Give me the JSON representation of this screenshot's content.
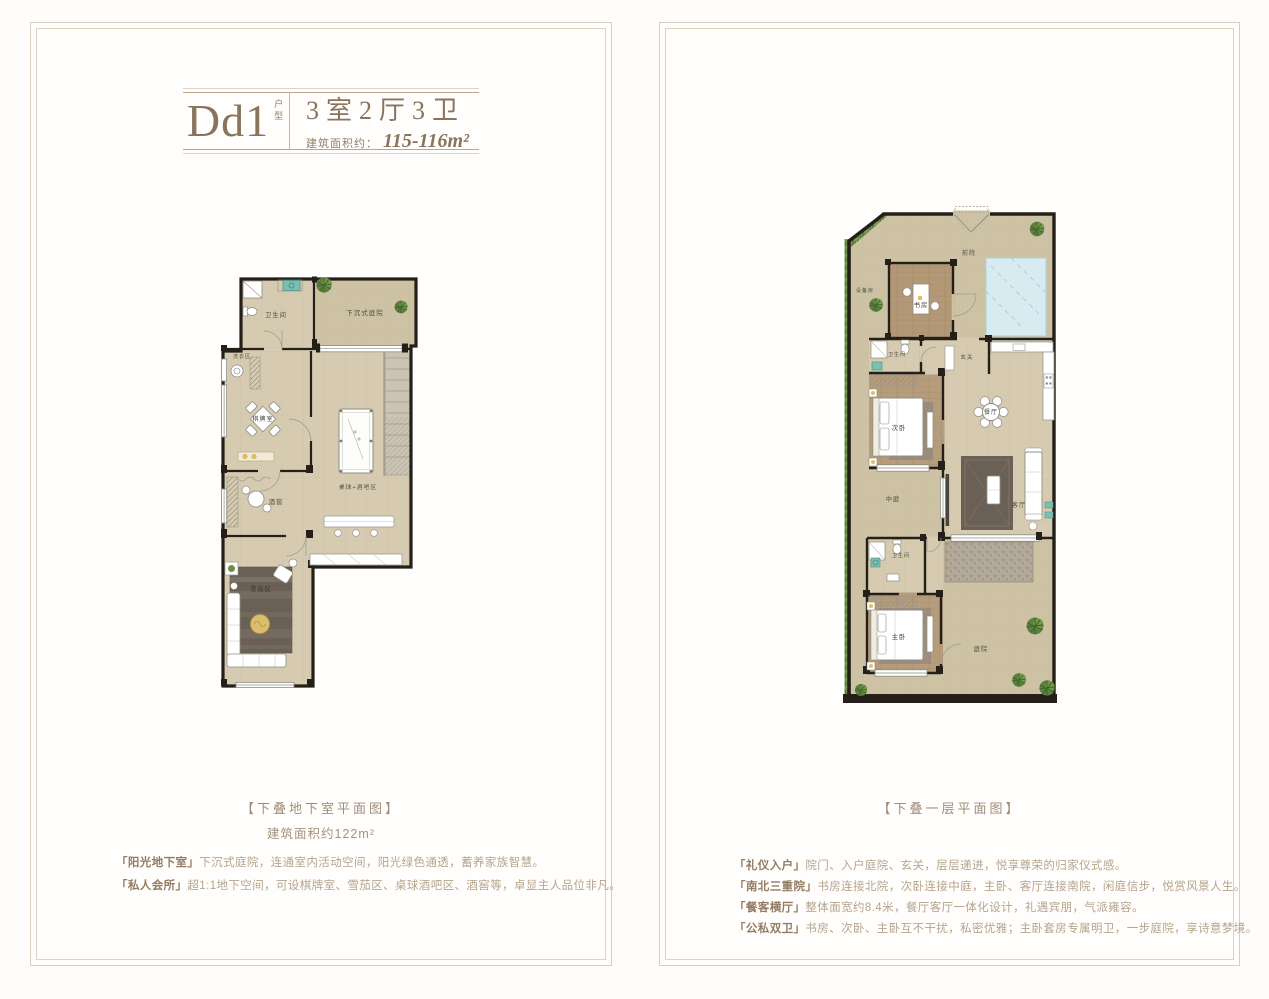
{
  "colors": {
    "brand_brown": "#8a745d",
    "desc_text": "#b5a48d",
    "frame_border": "#d9cfc0",
    "floor_tan": "#d6cbb0",
    "outdoor_tan": "#cdc3a4",
    "wall_black": "#241f19",
    "wood_floor": "#b29876",
    "water_blue": "#d8ebf1",
    "plant_green": "#5d8040",
    "accent_yellow": "#e3bf62",
    "fixture_teal": "#79c0b2"
  },
  "left_panel": {
    "header": {
      "code": "Dd1",
      "code_suffix": "户型",
      "layout": "3室2厅3卫",
      "area_label": "建筑面积约：",
      "area_value": "115-116m²"
    },
    "plan_rooms": {
      "bathroom": "卫生间",
      "sunken_courtyard": "下沉式庭院",
      "laundry": "洗衣区",
      "chess_room": "棋牌室",
      "wine_cellar": "酒窖",
      "billiard_bar": "桌球+酒吧区",
      "cigar_area": "雪茄区"
    },
    "caption": "【下叠地下室平面图】",
    "caption_sub": "建筑面积约122m²",
    "features": [
      {
        "name": "「阳光地下室」",
        "desc": "下沉式庭院，连通室内活动空间，阳光绿色通透，蓄养家族智慧。"
      },
      {
        "name": "「私人会所」",
        "desc": "超1:1地下空间，可设棋牌室、雪茄区、桌球酒吧区、酒窖等，卓显主人品位非凡。"
      }
    ]
  },
  "right_panel": {
    "plan_rooms": {
      "equipment_room": "设备房",
      "front_yard": "前院",
      "study": "书房",
      "bathroom": "卫生间",
      "foyer": "玄关",
      "second_bedroom": "次卧",
      "dining_room": "餐厅",
      "atrium": "中庭",
      "living_room": "客厅",
      "master_bathroom": "卫生间",
      "master_bedroom": "主卧",
      "courtyard": "庭院"
    },
    "caption": "【下叠一层平面图】",
    "features": [
      {
        "name": "「礼仪入户」",
        "desc": "院门、入户庭院、玄关，层层递进，悦享尊荣的归家仪式感。"
      },
      {
        "name": "「南北三重院」",
        "desc": "书房连接北院，次卧连接中庭，主卧、客厅连接南院，闲庭信步，悦赏风景人生。"
      },
      {
        "name": "「餐客横厅」",
        "desc": "整体面宽约8.4米，餐厅客厅一体化设计，礼遇宾朋，气派雍容。"
      },
      {
        "name": "「公私双卫」",
        "desc": "书房、次卧、主卧互不干扰，私密优雅；主卧套房专属明卫，一步庭院，享诗意梦境。"
      }
    ]
  }
}
